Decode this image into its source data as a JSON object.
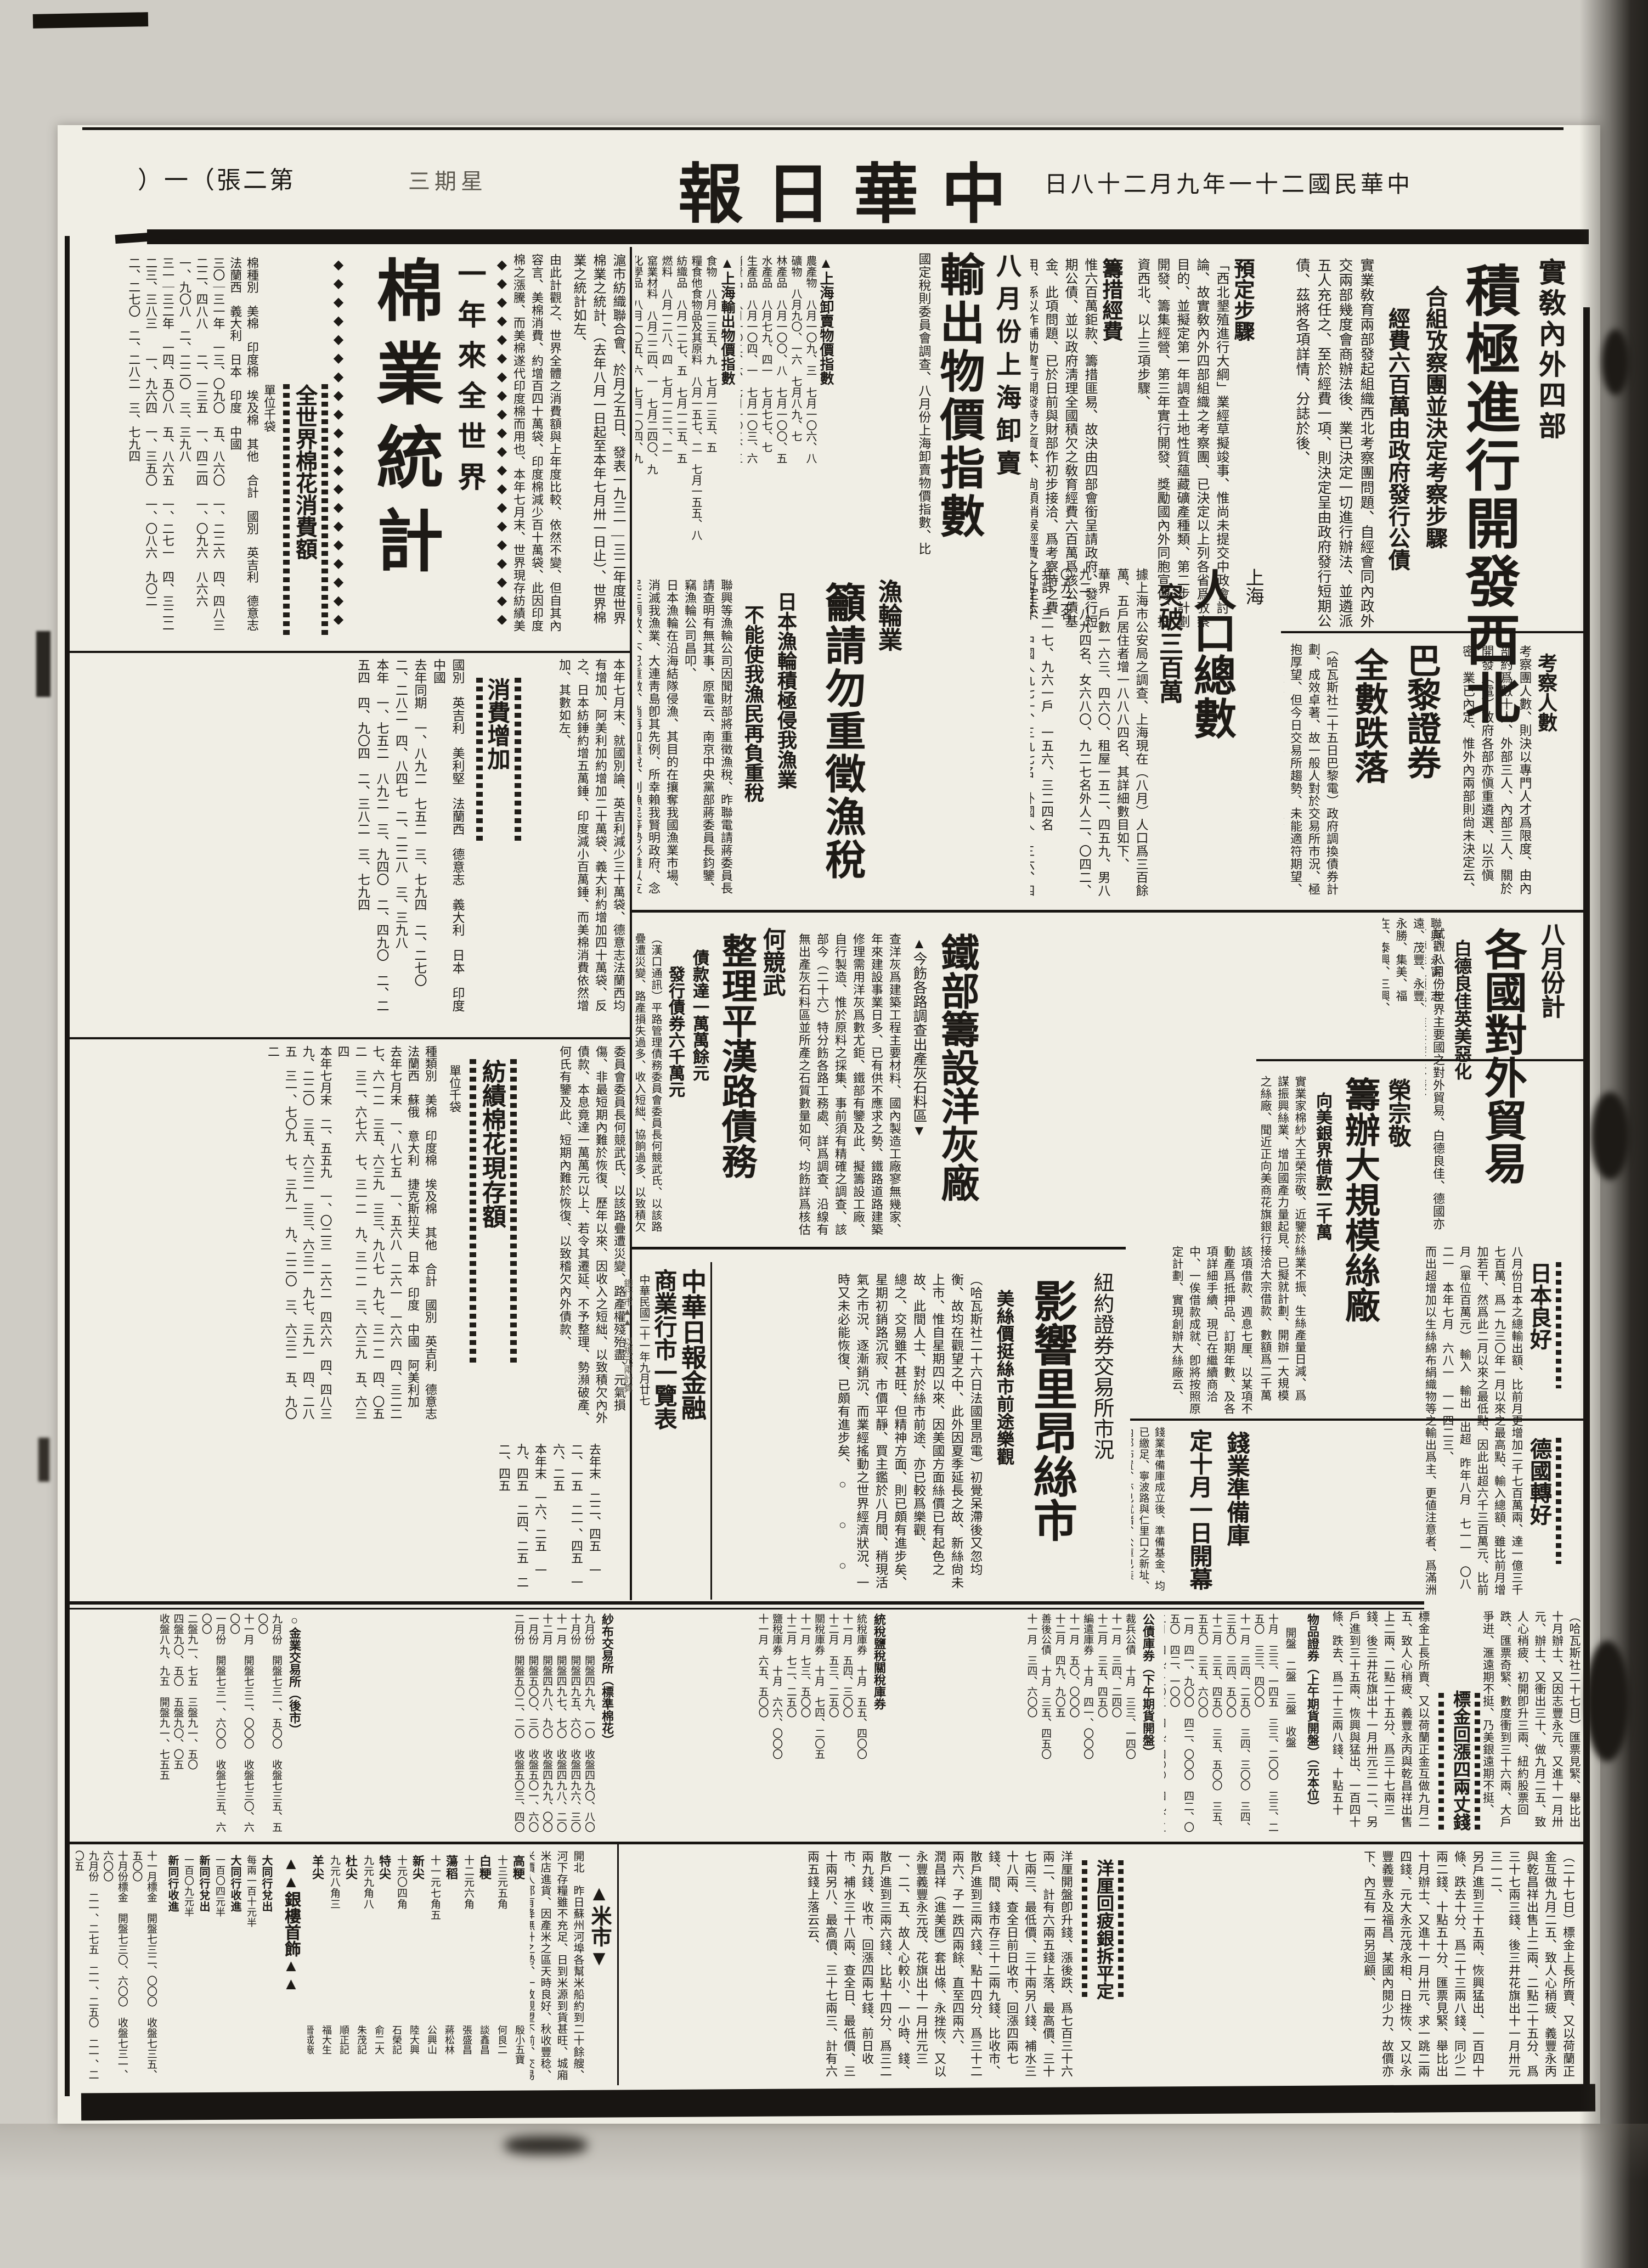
{
  "page": {
    "edition_chars": [
      "第",
      "二",
      "張",
      "（",
      "一",
      "）"
    ],
    "weekday_chars": [
      "星",
      "期",
      "三"
    ],
    "masthead_chars": [
      "中",
      "華",
      "日",
      "報"
    ],
    "date_chars": [
      "中",
      "華",
      "民",
      "國",
      "二",
      "十",
      "一",
      "年",
      "九",
      "月",
      "二",
      "十",
      "八",
      "日"
    ]
  },
  "decor": {
    "diamonds": "◆◆◆◆◆◆◆◆◆◆◆◆◆◆◆◆◆◆◆◆◆◆",
    "tri_up": "▲",
    "tri_down": "▼"
  },
  "articles": {
    "northwest": {
      "kicker": "實敎內外四部",
      "headline": "積極進行開發西北",
      "subhead1": "合組攷察團並決定考察步驟",
      "subhead2": "經費六百萬由政府發行公債",
      "lead": [
        "實業敎育兩部發起組織西北考察團問題、自經會同內政外交兩部幾度會商辦法後、業已決定一切進行辦法、並遴派五人充任之、至於經費一項、則決定呈由政府發行短期公債、茲將各項詳情、分誌於後、"
      ],
      "sec1_head": "預定步驟",
      "sec1_body": [
        "「西北墾殖進行大綱」業經草擬竣事、惟尚未提交中政會討論、故實敎內外四部組織之考察團、已決定以上列各省爲攷察目的、並擬定第一年調查土地性質蘊藏礦產種類、第二步計劃開發、籌集經營、第三年實行開發、獎勵國內外同胞宣傳、投資西北、以上三項步驟、"
      ],
      "sec2_head": "籌措經費",
      "sec2_body": [
        "惟六百萬鉅款、籌措匪易、故決由四部會銜呈請政府、發行短期公債、並以政府淸理全國積欠之敎育經費六百萬爲該公債基金、此項問題、已於日前與財部作初步接洽、爲考察時之費用、係以作輔助實行開發時之資本、尙須稍候經費之計定云、"
      ],
      "sec3_head": "考察人數",
      "sec3_body": [
        "考察團人數、則決以專門人才爲限度、由內部約爲數十人、外部三人、內部三人、關於開發（電）政府各部亦愼重遴選、以示愼密、業已內定、惟外內兩部則尙未決定云、"
      ]
    },
    "export_index": {
      "headline_top": "八月份上海卸賣",
      "headline": "輸出物價指數",
      "body": [
        "國定稅則委員會調查、八月份上海卸賣物價指數、比七月仍稍低、而輸出物價指數比七月份昂騰、其指數如下、"
      ],
      "t1_caption": "▲上海卸賣物價指數",
      "t1_cols": [
        "農產物　八月一〇九、三　七月一〇六、八",
        "礦物　八月九〇、一六　七月八九、七",
        "林產品　八月一〇〇、八　七月一〇〇、五",
        "水產品　八月七九、四一　七月七七、七",
        "生產品　八月一〇四、一　七月一〇三、六",
        "消費品　八月一〇二、六　七月一〇二、三",
        "總指數　八月八三、五　七月八一、五"
      ],
      "t2_caption": "▲上海輸出物價指數",
      "t2_cols": [
        "食物　八月一三五、九　七月一三五、五",
        "糧食他食物品及其原料　八月一五七、二　七月一五五、八",
        "紡織品　八月一二七、五　七月一二五、五",
        "燃料　八月一二八、四　七月一二二、二",
        "窰業材料　八月二二四、一　七月二四〇、九",
        "化學品　八月一〇五、六　七月一〇四、九",
        "雜類品　八月一一六、八　七月一一二、六",
        "總指數　八月一一一、八　七月一一二、一"
      ]
    },
    "fishing": {
      "kicker": "漁輪業",
      "headline": "籲請勿重徵漁稅",
      "subhead1": "日本漁輪積極侵我漁業",
      "subhead2": "不能使我漁民再負重稅",
      "body": [
        "聯興等漁輪公司因聞財部將重徵漁稅、昨聯電請蔣委員長請查明有無其事、原電云、南京中央黨部蔣委員長鈞鑒、竊漁輪公司昌叩、",
        "日本漁輪在沿海結隊侵漁、其目的在攘奪我國漁業市場、消滅我漁業、大連靑島卽其先例、所幸賴我賢明政府、念民生凋敝、不忍重徵、倘再加重稅、則漁民等勢必難以支持、殘喘不勝迫切之至、"
      ],
      "companies": [
        "聯興、永甯、志遠、茂豐、永豐、永勝、集美、福在、泰興、三興、中華等各漁輪公司昌叩成、"
      ]
    },
    "population": {
      "kicker": "上海",
      "headline": "人口總數",
      "subhead": "突破三百萬",
      "body": [
        "據上海市公安局之調查、上海現在（八月）人口爲三百餘萬、五戶居住者增一八八八四名、其詳細數目如下、",
        "華界　戶數一六三、四六〇、租屋一五二、四五九、男八九二、八九四名、女六八〇、九二七名外人二、〇四二、〇九二名",
        "共計　三一七、九六一戶　一五六、三二四名",
        "共同租界　中國人九七一、三九七名　外國人　三六、四七一名",
        "法租界　中國人四二一、八八五名　外國人　一二、九二二名"
      ]
    },
    "paris": {
      "headline1": "巴黎證券",
      "headline2": "全數跌落",
      "body": [
        "（哈瓦斯社二十五日巴黎電）政府調換債券計劃、成效卓著、故一般人對於交易所市況、極抱厚望、但今日交易所趨勢、未能適符期望、開盤各項行市、跌落、迨若干種證券、未幾卽有起色、",
        "但收盤時證券之跌落者、極見其多、法國公債行市、略受若干人拋售之影響、但公債在調換之列者、則市況堅挺、除調換之列者稍堅外、較之上星期五、幾全數跌落、頗得樂觀云、"
      ]
    },
    "cotton": {
      "headline_small": "一年來全世界",
      "headline": "棉業統計",
      "lead": [
        "滬市紡織聯合會、於月之五日、發表一九三一—三二年度世界棉業之統計、（去年八月一日起至本年七月卅一日止）、世界棉業之統計如左、"
      ],
      "consume_caption": "全世界棉花消費額",
      "consume_intro": [
        "由此計觀之、世界全體之消費額與上年度比較、依然不變、但自其內容言、美棉消費、約增百四十萬袋、印度棉減少百十萬袋、此因印度棉之漲騰、而美棉遂代印度棉而用也、本年七月末、世界現存紡績美棉比較去年同期、增七十萬袋、印度棉、仍減少五十萬袋以上、"
      ],
      "unit": "單位千袋",
      "consume_cols": [
        "棉種別　美棉　印度棉　埃及棉　其他　合計　國別　英吉利　德意志　法蘭西　義大利　日本　印度　中國",
        "三〇｜三一年　一三、〇九〇　五、八六〇　一、二二六　四、四八三　二二、四八八　　二、一三五　一、四二四　一、〇九六　八六六　一、九〇八　二、二二〇　三、三九八",
        "三一｜三二年　一四、五〇八　五、八六五　一、二七一　四、三二二　二三、三八三　　一、九六四　一、三五〇　一、〇八六　九〇二　二、二七〇　二、二八二　三、七九四"
      ],
      "increase_caption": "消費增加",
      "increase_intro": [
        "本年七月末、就國別論、英吉利減少三十萬袋、德意志法蘭西均有增加、阿美利加約增加二十萬袋、義大利約增加四十萬袋、反之、日本紡錘約增五萬錘、印度減小百萬錘、而美棉消費依然增加、其數如左、"
      ],
      "increase_cols": [
        "國別　英吉利　美利堅　法蘭西　德意志　義大利　日本　印度　中國",
        "去年同期　一、八九二　七五二　三、七九四　二、二七〇　二、二八二　四、八四七　二、二二八　三、三九八",
        "本年　一、七五二　八九二　三、九四〇　二、四九〇　二、二五四　四、九〇四　二、三八二　三、七九四"
      ],
      "stock_caption": "紡績棉花現存額",
      "stock_cols": [
        "種類別　美棉　印度棉　埃及棉　其他　合計　國別　英吉利　德意志　法蘭西　蘇俄　意大利　捷克斯拉夫　日本　印度　中國　阿美利加",
        "去年七月末　一、八七五　一、五六八　二六一　一六六　四、三二二　　七、六一二　三五、六三九　三三、九八七　九七、三一二　四、〇五二　三二、六七六　七、三一二　九、三一二　三、六三九　五、六三四",
        "本年七月末　二、五五九　一、〇二三　二六二　四六六　四、四八三　　九、二二〇　三五、六三二　三三、六三二　九七、三九一　四、二八五　三一、七〇九　七、三九一　九、二二〇　三、六三二　五、九〇二"
      ],
      "tail_cols": [
        "去年末　二二、四五　一二、一五　二一、四五　一六、二五",
        "本年末　一六、二五　一九、四五　二四、二五　二二、四五"
      ]
    },
    "pinghan_cont": [
      "委員會委員長何競武氏、以該路疊遭災變、路產權殘殆盡、元氣損傷、非最短期內難於恢復、歷年以來、因收入之短絀、以致積欠內外債款、本息竟達一萬萬元以上、若令其遷延、不予整理、勢瀕破產、何氏有鑒及此、短期內難於恢復、以致稽欠內外債款、"
    ],
    "trade": {
      "kicker": "八月份計",
      "headline": "各國對外貿易",
      "subhead": "白德良佳英美惡化",
      "intro": [
        "試觀八月份世界主要國之對外貿易、白德良佳、德國亦有轉佳之預兆、惟英美甚不振、"
      ],
      "japan_caption": "日本良好",
      "germany_caption": "德國轉好",
      "body": [
        "八月份日本之總輸出額、比前月更增加二千七百萬兩、達一億三千七百萬、爲一九三〇年一月以來之最高點、輸入總額、雖比前月增加若干、然爲此二月以來之最低點、因此出超六千三百萬元、比前月（單位百萬元）　輸入　輸出　出超　昨年八月　七一一　〇八二一　本年七月　六八一　一一四二三、",
        "而出超增加以生絲綿布絹織物等之輸出爲主、更値注意者、爲滿洲與關東州之貿易、同時金銀塊輸出入狀態有顯著改善、八月份入超二千萬馬克、（未完）"
      ]
    },
    "cement": {
      "headline": "鐵部籌設洋灰廠",
      "subhead": "▲今飭各路調查出產灰石料區▼",
      "body": [
        "查洋灰爲建築工程主要材料、國內製造工廠寥無幾家、年來建設事業日多、已有供不應求之勢、鐵路道路建築修理需用洋灰爲數尤鉅、鐵部有鑒及此、擬籌設工廠、自行製造、惟於原料之採集、事前須有精確之調查、該部今（二十六）特分飭各路工務處、詳爲調查、沿線有無出產灰石料區並所產之石質數量如何、均飭詳爲核估列表呈報、以資研究云、"
      ]
    },
    "pinghan": {
      "kicker": "何競武",
      "headline": "整理平漢路債務",
      "subhead1": "債款達一萬萬餘元",
      "subhead2": "發行債券六千萬元",
      "body": [
        "（漢口通訊）平路管理債務委員會委員長何競武氏、以該路疊遭災變、路產損失過多、收入短絀、協餉過多、以致積欠內外債款本息、竟達一萬萬元以上、若令其遷延、不予整理、勢瀕破產、何氏有鑒及此、爰擬整理債務辦法、發行債券六千萬元、淸理一百萬兩、及川漢路借款、豐匯理借款一萬零八百萬元、負債截至現可遵照發行核示、"
      ]
    },
    "rong": {
      "kicker": "榮宗敬",
      "headline": "籌辦大規模絲廠",
      "subhead": "向美銀界借款二千萬",
      "body": [
        "實業家棉紗大王榮宗敬、近鑒於絲業不振、生絲產量日減、爲謀振興絲業、增加國產力量起見、已擬就計劃、開辦一大規模之絲廠、聞近正向美商花旗銀行接洽大宗借款、數額爲二千萬元、接洽數次、進行頗爲順利、"
      ],
      "cont": [
        "該項借款、週息七厘、以某項不動產爲抵押品、訂期年數、及各項詳細手續、現已在繼續商洽中、一俟借款成就、卽將按照原定計劃、實現創辦大絲廠云、"
      ]
    },
    "qianye": {
      "headline_top": "錢業準備庫",
      "headline": "定十月一日開幕",
      "body": [
        "錢業準備庫成立後、準備基金、均已繳足、寧波路與仁里口之新址、內部佈置、亦已就緒、公庫已裝妥、決定於十月一日開幕、正式對外辦公、時間爲上午九時至下午五時、總經理爲秦潤卿氏、屆時雖不舉行儀式、但必有一番盛況云、"
      ]
    },
    "lyon": {
      "kicker": "紐約證券交易所市況",
      "headline": "影響里昂絲市",
      "subhead": "美絲價挺絲市前途樂觀",
      "body": [
        "（哈瓦斯社二十六日法國里昂電）初覺呆滯後又忽均衡、故均在觀望之中、此外因夏季延長之故、新絲尙未上市、惟自星期四以來、因美國方面絲價已有起色之故、此間人士、對於絲市前途、亦已較爲樂觀、",
        "總之、交易雖不甚旺、但精神方面、則已頗有進步矣、星期初銷路沉寂、市價平靜、買主鑑於八月間、稍現活氣之市況、逐漸銷沉、而業經搖動之世界經濟狀況、一時又未必能恢復、已頗有進步矣、　○　　○　　○"
      ]
    },
    "gold": {
      "caption": "標金回漲四兩丈錢",
      "body_r": [
        "（哈瓦斯社二十七日）匯票見緊、舉比出十月辦士、又因志豐永元、又進十一月卅元、辦士、又衝出三十、做九月二五、致人心稍疲、初開卽升三兩、紐約股票回跌、匯票奇緊、數度衝到三十六兩、大戶爭逬、滙遠期不挺、乃美銀遠期不挺、"
      ],
      "body_l": [
        "標金上長所賣、又以荷蘭正金互做九月二五、致人心稍疲、義豐永丙與乾昌祥出售上二兩、二點二十五分、爲三十七兩三錢、後三井花旗出十一月卅元三一二、另戶進到三十五兩、恢興與猛出、一百四十條、跌去、爲二十三兩八錢、十點五十分、爲三十六兩一錢、（未完）"
      ]
    },
    "yangli": {
      "caption": "洋厘回疲銀拆平定",
      "body_r": [
        "（二十七日）標金上長所賣、又以荷蘭正金互做九月二五、致人心稍疲、義豐永丙與乾昌祥出售上二兩、二點二十五分、爲三十七兩三錢、後三井花旗出十一月卅元三一二、",
        "另戶進到三十五兩、恢興猛出、一百四十條、跌去十分、爲二十三兩八錢、同少二兩二錢、十點五十分、匯票見緊、舉比出十月辦士、又進十一月卅元、求一跳二兩四錢、元大永元茂永相、日挫恢、又以永豐義豐永及福昌、某國內閱少力、故價亦下、內互有一兩另迴顧、"
      ],
      "body_l": [
        "洋厘開盤卽升錢、漲後跌、爲七百三十六兩二、計有六兩五錢上落、最高價、三十七兩三、最低價、三十兩另八錢、補水三十八兩、查全日前日收市、回漲四兩七錢、間、錢市存三十二兩九錢、比收市、散戶進到三兩六錢、點十四分、爲三十二兩六、子一跌四兩餘、直至四兩六、",
        "潤昌祥（進美匯）套出條、永挫恢、又以永豐義豐永元茂、花旗出十一月卅元三一、二、五、故人心較小、一小時、錢、散戶進到三兩六錢、比點十四分、爲三二兩九錢、收市、回漲四兩七錢、前日收市、補水三十八兩、查全日、最低價、三十兩另八、最高價、三十七兩三、計有六兩五錢上落云云、"
      ]
    }
  },
  "market_table": {
    "title_col1": "中華日報金融",
    "title_col2": "商業行市一覽表",
    "date": "中華民國二十一年九月廿七",
    "note": "銀行市▲▲　以規元兩計算"
  },
  "tables": {
    "g1": {
      "caption": "物品證券（上午期貨開盤）（元本位）",
      "labels": "開盤　二盤　三盤　收盤",
      "cols": [
        "十月　三三、一四五　三三、二〇〇　三三、二五〇　三三、四〇〇",
        "十一月　三四、二五〇　三四、三〇〇　三四、三五〇　三四、五〇〇",
        "十二月　三五、四五〇　三五、五〇〇　三五、五五〇　三五、六〇〇",
        "一月　四一、九〇〇　四二、〇〇〇　四二、〇五〇　四二、一〇〇",
        "二月　四九、三〇五　四九、四〇〇　四九、五〇〇　四九、九〇五"
      ]
    },
    "g2": {
      "caption": "公債庫券（下午期貨開盤）",
      "cols": [
        "裁兵公債　十月　三三、一四〇",
        "十一月　三四、二四〇",
        "十二月　三五、四五〇",
        "編遣庫券　十月　四一、〇〇〇",
        "十一月　五〇、〇〇〇",
        "十二月　四九、九〇五",
        "善後公債　十月　三五、四五〇",
        "十一月　三四、六〇〇"
      ]
    },
    "g3": {
      "caption": "統稅鹽稅關稅庫券",
      "cols": [
        "統稅庫券　十月　五五、四〇〇",
        "十一月　五四、三〇〇",
        "十二月　五三、二五〇",
        "關稅庫券　十月　七四、二〇五",
        "十一月　七三、五〇〇",
        "十二月　七二、二五〇",
        "鹽稅庫券　十月　六六、〇〇〇",
        "十一月　六五、五〇〇"
      ]
    },
    "g4": {
      "caption": "紗布交易所（標準棉花）",
      "cols": [
        "九月份　開盤四九九、一〇　收盤四九〇、八〇",
        "十月份　開盤四九五、六〇　收盤四九六、三〇",
        "十一月　開盤四九七、七〇　收盤四九八、二〇",
        "十二月　開盤四九八、九〇　收盤四九九、〇〇",
        "一月份　開盤五〇〇、三〇　收盤五〇一、六〇",
        "二月份　開盤五〇二、二〇　收盤五〇三、四〇"
      ]
    },
    "g5": {
      "caption": "○金業交易所（後市）",
      "cols": [
        "九月份　開盤七三一、五〇〇　收盤七三五、五〇〇",
        "十一月　開盤七三二、〇〇〇　收盤七三〇、六〇〇",
        "一月份　開盤七三一、六〇〇　收盤七三五、六〇〇",
        "二盤九一、七五　三盤九一、五〇",
        "四盤九〇、五〇　五盤九〇、〇五",
        "收盤八九、九五　開盤九一、七五五"
      ]
    }
  },
  "bottom": {
    "rice": {
      "caption": "▲米市▼",
      "intro": [
        "開北　昨日蘇州河埠各幫米船約到二十餘艘、河下存糧雖不充足、日到米源到貨甚旺、城廂米店進貨、因產米之區天時良好、秋收豐稔、米價人都有降無升之勢、一致觀望不前、交易零星、滬北糧降底角許、茲將解閘之米價如左、"
      ],
      "dealers": [
        {
          "name": "高粳",
          "price": "十三元五角"
        },
        {
          "name": "白粳",
          "price": "十二元六角"
        },
        {
          "name": "蕩稻",
          "price": "十一元七角五"
        },
        {
          "name": "新尖",
          "price": "十元〇四角"
        },
        {
          "name": "特尖",
          "price": "九元九角八"
        },
        {
          "name": "杜尖",
          "price": "九元八角三"
        },
        {
          "name": "羊尖",
          "price": "九元〇八角"
        },
        {
          "name": "蟬尖",
          "price": "八元八角三"
        },
        {
          "name": "又稻",
          "price": "八元八角"
        }
      ],
      "shops": [
        "殷小五寶",
        "何良二",
        "談鑫昌",
        "張盛昌",
        "蔣松林",
        "公興山",
        "陸大興",
        "石榮記",
        "俞二大",
        "朱茂記",
        "順正記",
        "福大生",
        "晉成廠",
        "萬昌林",
        "沈金呼",
        "馬榮貴"
      ]
    },
    "silver": {
      "caption": "▲▲銀樓首飾▲▲",
      "rows": [
        {
          "label": "大同行兌出",
          "value": "每兩一百十元半"
        },
        {
          "label": "大同行收進",
          "value": "一百〇四元半"
        },
        {
          "label": "新同行兌出",
          "value": "一百〇九元半"
        },
        {
          "label": "新同行收進",
          "value": "一百〇三元半"
        },
        {
          "label": "首飾敕銀",
          "value": "一元七角五分"
        }
      ]
    },
    "misc_cols": [
      "十一月標金　開盤七三二、〇〇〇　收盤七三五、五〇〇",
      "十月份標金　開盤七三〇、六〇〇　收盤七三一、六〇〇",
      "九月份　二一、二七五　二一、二五〇　二一、二〇五"
    ]
  }
}
